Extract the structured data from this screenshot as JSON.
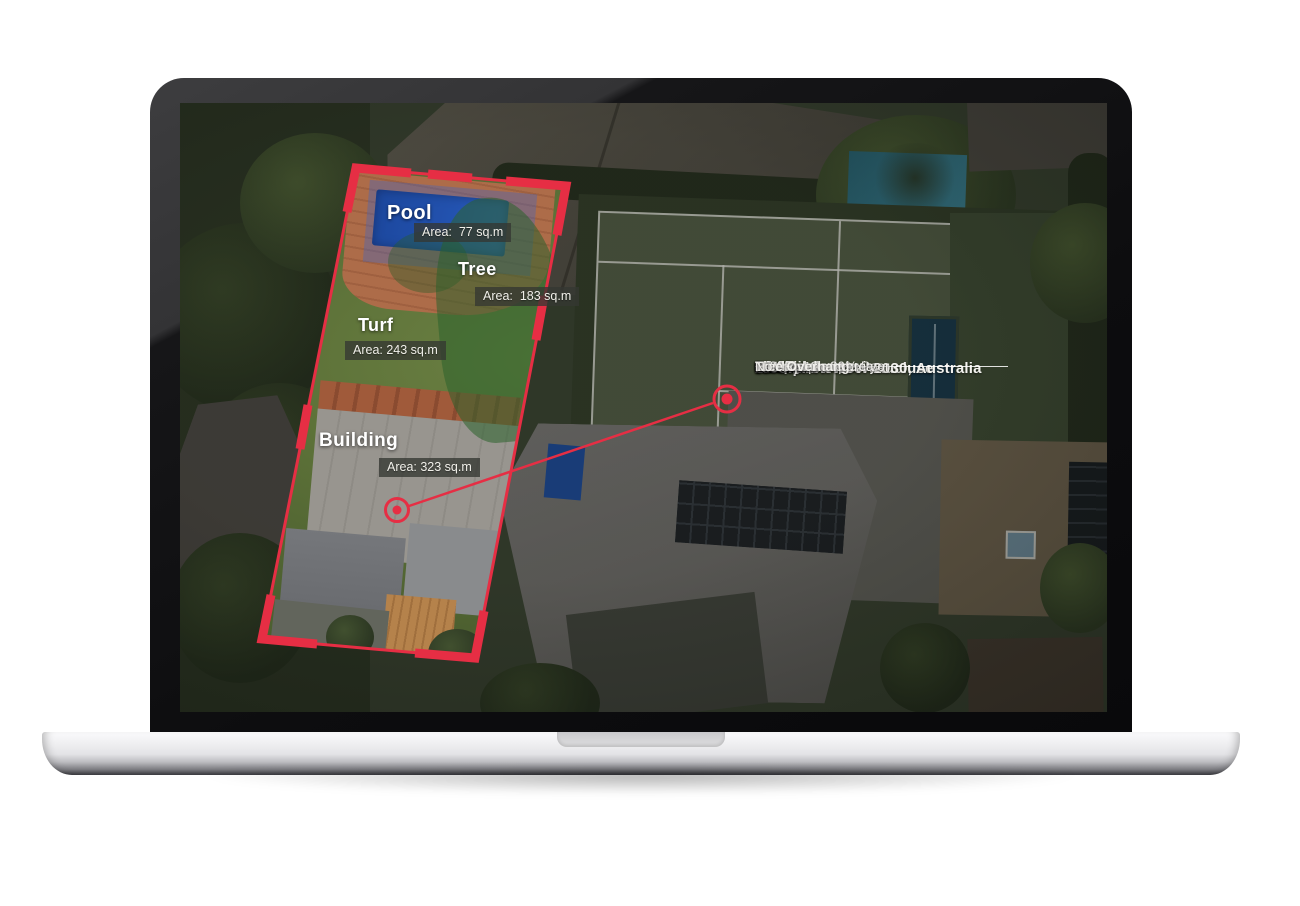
{
  "colors": {
    "accent": "#e62e44",
    "badge_background": "rgba(52,55,50,0.78)",
    "text": "#f3f2ee"
  },
  "map_regions": {
    "pool": {
      "label": "Pool",
      "area": "Area:  77 sq.m"
    },
    "tree": {
      "label": "Tree",
      "area": "Area:  183 sq.m"
    },
    "turf": {
      "label": "Turf",
      "area": "Area: 243 sq.m"
    },
    "building": {
      "label": "Building",
      "area": "Area: 323 sq.m"
    }
  },
  "info_panel": {
    "address_line1": "20 Olphert Ave Vaucluse",
    "address_line2": "Woollahra NSW 2030, Australia",
    "sections": [
      {
        "title": "Roof",
        "rows": [
          {
            "label": "Area:",
            "value": "323  sq.m"
          },
          {
            "label": "Condition:",
            "value": "80% Good , 20% Poor"
          },
          {
            "label": "Shape:",
            "value": "Flat/Low Complexity"
          },
          {
            "label": "Material:",
            "value": "Metal"
          }
        ]
      },
      {
        "title": "Risk",
        "rows": [
          {
            "label": "Bushfire:",
            "value": "Bushfire prone area"
          },
          {
            "label": "Flood:",
            "value": "<5%"
          },
          {
            "label": "Earthquake:",
            "value": "Low-Risk"
          },
          {
            "label": "Tree Overhang:",
            "value": "No"
          }
        ]
      }
    ]
  }
}
